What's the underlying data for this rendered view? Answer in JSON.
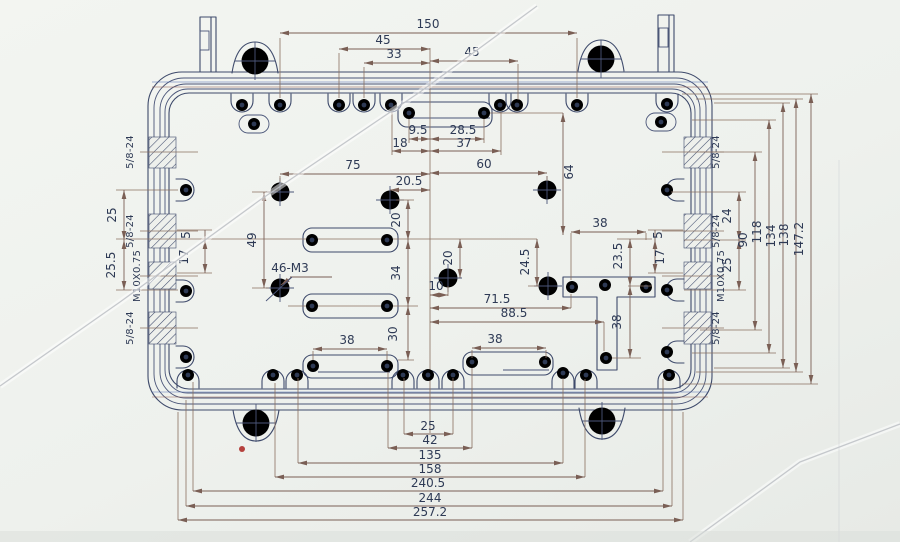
{
  "drawing": {
    "dims_top": {
      "overall": "150",
      "left45": "45",
      "mid33": "33",
      "right45": "45",
      "slot95": "9.5",
      "slot285": "28.5",
      "slot18": "18",
      "slot37": "37",
      "v64": "64"
    },
    "dims_upper": {
      "h75": "75",
      "h60": "60",
      "h205": "20.5"
    },
    "dims_left": {
      "v25": "25",
      "v255": "25.5",
      "v5": "5",
      "v17": "17"
    },
    "threads_left": {
      "t1": "5/8-24",
      "t2": "5/8-24",
      "t3": "M10X0.75",
      "t4": "5/8-24"
    },
    "threads_right": {
      "t1": "5/8-24",
      "t2": "5/8-24",
      "t3": "M10X0.75",
      "t4": "5/8-24"
    },
    "dims_center": {
      "v49": "49",
      "v20": "20",
      "v34": "34",
      "v30": "30",
      "note46m3": "46-M3",
      "v20c": "20",
      "h10": "10",
      "h715": "71.5",
      "h885": "88.5",
      "v245": "24.5",
      "v235": "23.5",
      "h38t": "38",
      "v38stem": "38",
      "h38bl": "38",
      "h38br": "38"
    },
    "dims_right": {
      "v24": "24",
      "v25": "25",
      "v5": "5",
      "v17": "17",
      "v90": "90",
      "v118": "118",
      "v134": "134",
      "v138": "138",
      "v1472": "147.2"
    },
    "dims_bottom": {
      "h25": "25",
      "h42": "42",
      "h135": "135",
      "h158": "158",
      "h2405": "240.5",
      "h244": "244",
      "h2572": "257.2"
    },
    "colors": {
      "ink": "#3e4a6b",
      "dim_ink": "#7a5f55",
      "paper": "#eef0ec",
      "red_mark": "#b5413d"
    }
  }
}
